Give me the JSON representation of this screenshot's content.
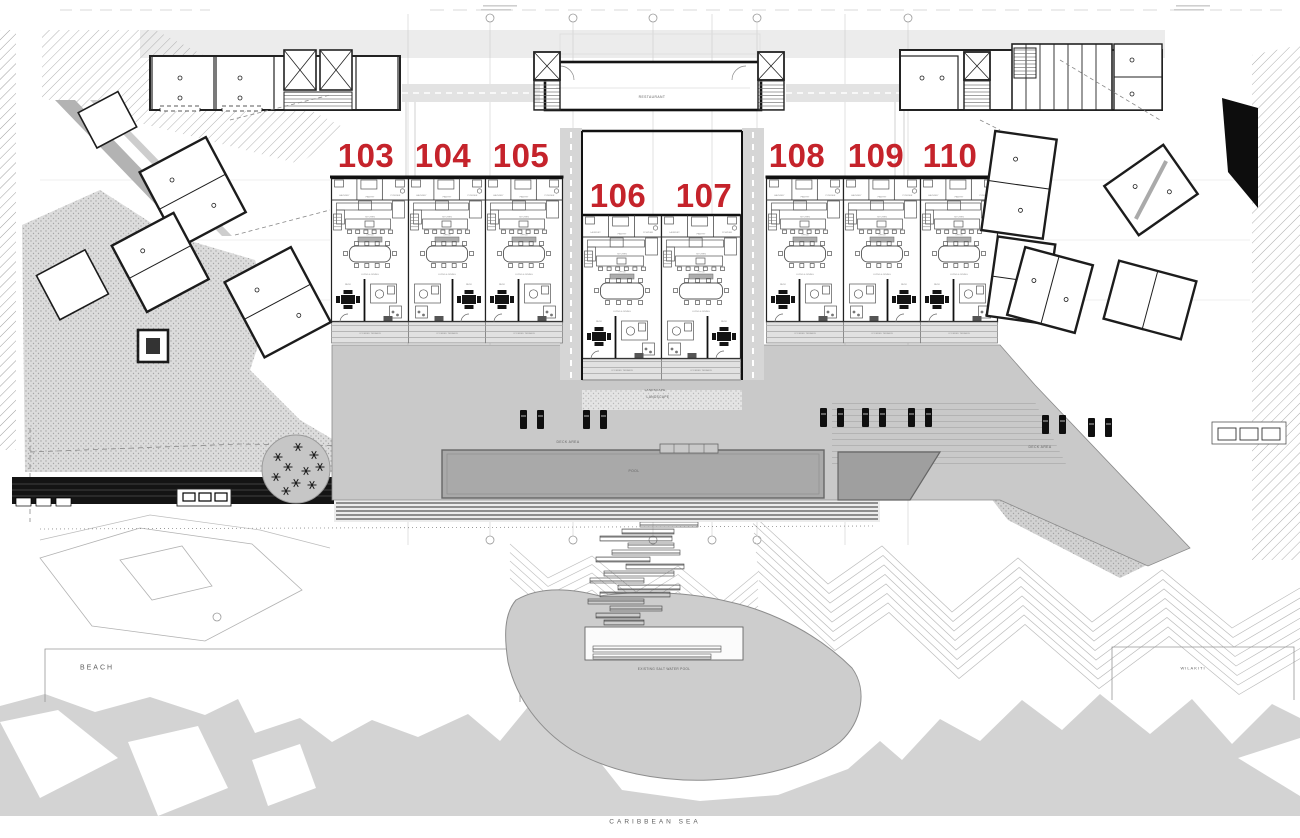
{
  "plan": {
    "unit_number_color": "#c5232b",
    "units": [
      {
        "number": "103",
        "x": 366,
        "y": 139,
        "ux": 331.5,
        "uy": 178,
        "w": 77,
        "mirrored": false
      },
      {
        "number": "104",
        "x": 443,
        "y": 139,
        "ux": 408.5,
        "uy": 178,
        "w": 77,
        "mirrored": true
      },
      {
        "number": "105",
        "x": 521,
        "y": 139,
        "ux": 485.5,
        "uy": 178,
        "w": 77,
        "mirrored": false
      },
      {
        "number": "106",
        "x": 618,
        "y": 179,
        "ux": 582.5,
        "uy": 215,
        "w": 79,
        "mirrored": false
      },
      {
        "number": "107",
        "x": 704,
        "y": 179,
        "ux": 661.5,
        "uy": 215,
        "w": 79,
        "mirrored": true
      },
      {
        "number": "108",
        "x": 797,
        "y": 139,
        "ux": 766.5,
        "uy": 178,
        "w": 77,
        "mirrored": false
      },
      {
        "number": "109",
        "x": 876,
        "y": 139,
        "ux": 843.5,
        "uy": 178,
        "w": 77,
        "mirrored": true
      },
      {
        "number": "110",
        "x": 950,
        "y": 139,
        "ux": 920.5,
        "uy": 178,
        "w": 77,
        "mirrored": false
      }
    ],
    "site_labels": [
      {
        "text": "BEACH",
        "x": 97,
        "y": 668,
        "size": 7,
        "spacing": 2
      },
      {
        "text": "CARIBBEAN SEA",
        "x": 655,
        "y": 822,
        "size": 6.5,
        "spacing": 3
      },
      {
        "text": "WILAKITI",
        "x": 1193,
        "y": 668,
        "size": 4,
        "spacing": 1
      },
      {
        "text": "RESTAURANT",
        "x": 652,
        "y": 97,
        "size": 3.4,
        "spacing": 0.4
      },
      {
        "text": "DECK AREA",
        "x": 568,
        "y": 442,
        "size": 3.4,
        "spacing": 0.4
      },
      {
        "text": "DECK AREA",
        "x": 1040,
        "y": 447,
        "size": 3.4,
        "spacing": 0.4
      },
      {
        "text": "POOL",
        "x": 634,
        "y": 471,
        "size": 3.4,
        "spacing": 0.4
      },
      {
        "text": "LANDSCAPE",
        "x": 658,
        "y": 397,
        "size": 3.2,
        "spacing": 0.4
      },
      {
        "text": "LANDSCAPE",
        "x": 655,
        "y": 390,
        "size": 3.0,
        "spacing": 0.3
      },
      {
        "text": "EXISTING SALT WATER POOL",
        "x": 664,
        "y": 669,
        "size": 3.2,
        "spacing": 0.3
      }
    ],
    "unit_rooms": {
      "laundry": "LAUNDRY",
      "pantry": "PANTRY",
      "powder": "POWDER",
      "kitchen": "KITCHEN",
      "office": "OFFICE",
      "living": "LIVING & DINING",
      "patio": "PATIO",
      "terrace": "COVERED TERRACE"
    }
  }
}
